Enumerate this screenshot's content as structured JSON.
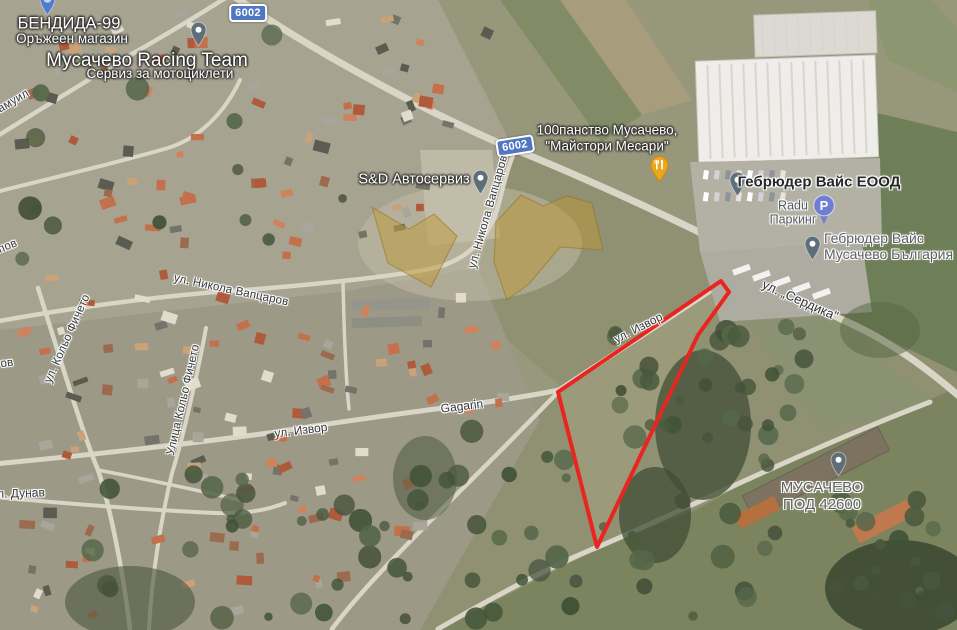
{
  "map": {
    "type": "satellite",
    "locality": "Мусачево"
  },
  "colors": {
    "parcel_red": "#e8261f",
    "gold_fill": "rgba(189,152,54,0.5)",
    "gold_stroke": "rgba(146,110,20,0.55)",
    "badge_blue": "#5277c2",
    "pin_grey": "#5d6e79",
    "pin_blue": "#4d7cc9",
    "restaurant_orange": "#eca61d",
    "parking_blue": "#707ed2"
  },
  "road_badges": [
    {
      "name": "road-badge-6002-top",
      "label": "6002",
      "x": 248,
      "y": 13,
      "rot": 0
    },
    {
      "name": "road-badge-6002-mid",
      "label": "6002",
      "x": 515,
      "y": 146,
      "rot": -9
    }
  ],
  "markers": [
    {
      "name": "bendida-pin",
      "type": "pin-blue",
      "x": 47,
      "y": 16
    },
    {
      "name": "racing-team-pin",
      "type": "pin-grey",
      "x": 198,
      "y": 47
    },
    {
      "name": "sd-autoservice-pin",
      "type": "pin-grey",
      "x": 480,
      "y": 195
    },
    {
      "name": "restaurant-marker",
      "type": "restaurant",
      "x": 659,
      "y": 182
    },
    {
      "name": "gebruder-weiss-eood-pin",
      "type": "pin-grey",
      "x": 737,
      "y": 197
    },
    {
      "name": "parking-badge",
      "type": "parking",
      "x": 824,
      "y": 205
    },
    {
      "name": "gebruder-weiss-musachevo-pin",
      "type": "pin-grey",
      "x": 812,
      "y": 261
    },
    {
      "name": "musachevo-pod-pin",
      "type": "pin-grey",
      "x": 838,
      "y": 477
    }
  ],
  "labels": [
    {
      "name": "bendida-label",
      "text": "БЕНДИДА-99",
      "x": 69,
      "y": 24,
      "rot": 0,
      "style": "place-white-lg"
    },
    {
      "name": "bendida-sublabel",
      "text": "Оръжеен магазин",
      "x": 72,
      "y": 39,
      "rot": 0,
      "style": "place-white-sm"
    },
    {
      "name": "racing-team-label",
      "text": "Мусачево Racing Team",
      "x": 147,
      "y": 61,
      "rot": 0,
      "style": "place-white-xl"
    },
    {
      "name": "racing-team-sublabel",
      "text": "Сервиз за мотоциклети",
      "x": 160,
      "y": 74,
      "rot": 0,
      "style": "place-white-sm"
    },
    {
      "name": "sd-autoservice-label",
      "text": "S&D Автосервиз",
      "x": 414,
      "y": 180,
      "rot": 0,
      "style": "place-white-md"
    },
    {
      "name": "farm-label",
      "text": "100панство Мусачево,\n\"Майстори Месари\"",
      "x": 607,
      "y": 138,
      "rot": 0,
      "style": "place-white-sm"
    },
    {
      "name": "gebruder-weiss-eood-label",
      "text": "Гебрюдер Вайс ЕООД",
      "x": 819,
      "y": 182,
      "rot": 0,
      "style": "business-dark"
    },
    {
      "name": "radu-parking-label",
      "text": "Radu\nПаркинг",
      "x": 793,
      "y": 213,
      "rot": 0,
      "style": "poi-grey-sm"
    },
    {
      "name": "gebruder-weiss-musachevo-label",
      "text": "Гебрюдер Вайс\nМусачево България",
      "x": 824,
      "y": 246,
      "rot": 0,
      "style": "poi-grey",
      "anchor": "left"
    },
    {
      "name": "musachevo-pod-label",
      "text": "МУСАЧЕВО\nПОД 42600",
      "x": 822,
      "y": 496,
      "rot": 0,
      "style": "poi-grey-lg"
    },
    {
      "name": "street-vaptsarov-diagonal",
      "text": "ул. Никола Вапцаров",
      "x": 231,
      "y": 291,
      "rot": 12,
      "style": "street"
    },
    {
      "name": "street-vaptsarov-vertical",
      "text": "ул. Никола Вапцаров",
      "x": 489,
      "y": 212,
      "rot": -74,
      "style": "street"
    },
    {
      "name": "street-kolyo-ficheto-west",
      "text": "ул. Кольо Фичето",
      "x": 68,
      "y": 339,
      "rot": -66,
      "style": "street"
    },
    {
      "name": "street-kolyo-ficheto-east",
      "text": "Улица Кольо Фичето",
      "x": 184,
      "y": 400,
      "rot": -77,
      "style": "street"
    },
    {
      "name": "street-serdika",
      "text": "ул. „Сердика\"",
      "x": 800,
      "y": 301,
      "rot": 24,
      "style": "street-lg"
    },
    {
      "name": "street-izvor-parcel",
      "text": "ул. Извор",
      "x": 639,
      "y": 329,
      "rot": -27,
      "style": "street"
    },
    {
      "name": "street-izvor-west",
      "text": "ул. Извор",
      "x": 301,
      "y": 431,
      "rot": -7,
      "style": "street-md"
    },
    {
      "name": "street-gagarin",
      "text": "Gagarin",
      "x": 462,
      "y": 407,
      "rot": -7,
      "style": "street-md"
    },
    {
      "name": "street-samuil-fragment",
      "text": "Самуил",
      "x": 10,
      "y": 104,
      "rot": -31,
      "style": "street"
    },
    {
      "name": "street-ov-fragment",
      "text": "ов",
      "x": 7,
      "y": 364,
      "rot": -8,
      "style": "street"
    },
    {
      "name": "street-pov-fragment",
      "text": "пов",
      "x": 8,
      "y": 247,
      "rot": -22,
      "style": "street"
    },
    {
      "name": "street-dunav-fragment",
      "text": "л. Дунав",
      "x": 21,
      "y": 494,
      "rot": -2,
      "style": "street-md"
    }
  ],
  "overlays": {
    "red_parcel": {
      "points": "721,281 729,292 698,335 597,547 558,392",
      "stroke": "#e8261f",
      "width": 4
    },
    "gold_shapes": [
      {
        "points": "372,207 409,229 434,214 457,236 431,287 388,263"
      },
      {
        "points": "496,222 521,195 543,206 567,196 592,203 603,250 560,247 529,284 507,300 494,262"
      }
    ]
  }
}
